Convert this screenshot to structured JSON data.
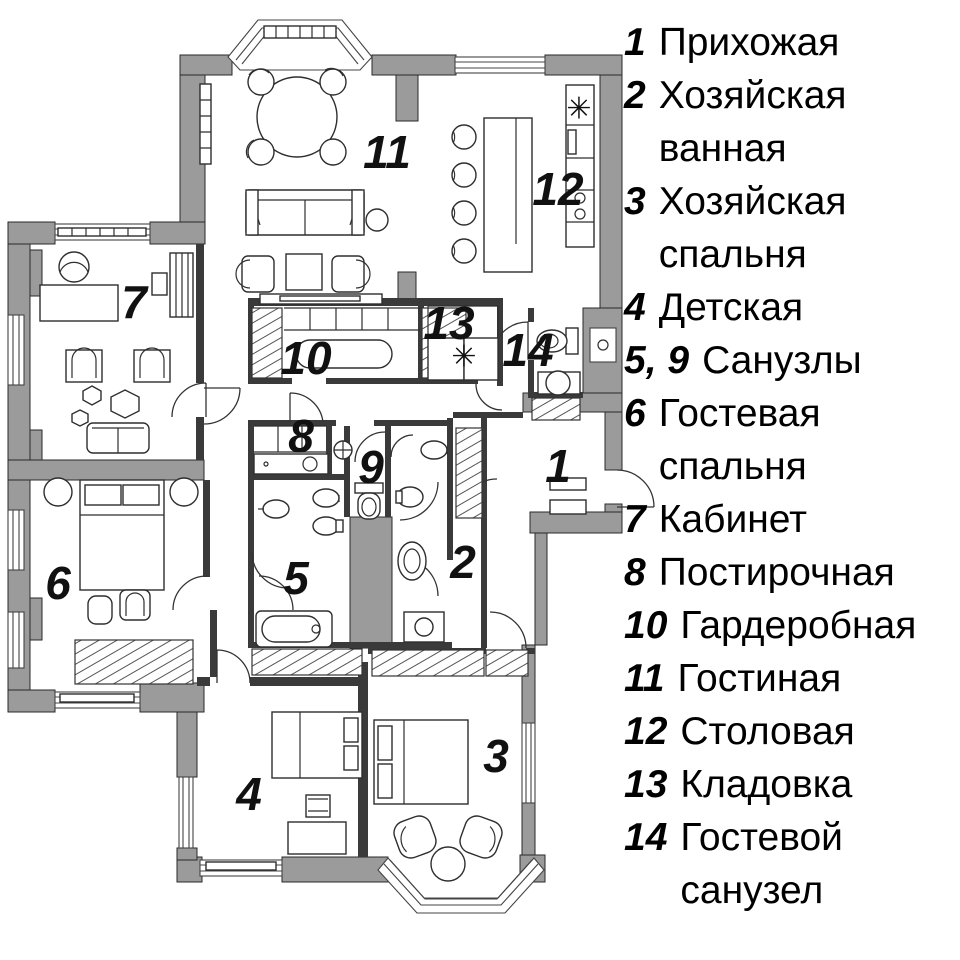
{
  "title": "Apartment floor plan with room legend",
  "colors": {
    "wall": "#9b9b9b",
    "line": "#2e2e2e",
    "background": "#ffffff",
    "text": "#000000"
  },
  "legend": {
    "items": [
      {
        "number": "1",
        "label": "Прихожая"
      },
      {
        "number": "2",
        "label": "Хозяйская ванная"
      },
      {
        "number": "3",
        "label": "Хозяйская спальня"
      },
      {
        "number": "4",
        "label": "Детская"
      },
      {
        "number": "5, 9",
        "label": "Санузлы"
      },
      {
        "number": "6",
        "label": "Гостевая спальня"
      },
      {
        "number": "7",
        "label": "Кабинет"
      },
      {
        "number": "8",
        "label": "Постирочная"
      },
      {
        "number": "10",
        "label": "Гардеробная"
      },
      {
        "number": "11",
        "label": "Гостиная"
      },
      {
        "number": "12",
        "label": "Столовая"
      },
      {
        "number": "13",
        "label": "Кладовка"
      },
      {
        "number": "14",
        "label": "Гостевой санузел"
      }
    ]
  },
  "plan": {
    "room_labels": [
      {
        "number": "1",
        "x": 558,
        "y": 470
      },
      {
        "number": "2",
        "x": 463,
        "y": 566
      },
      {
        "number": "3",
        "x": 496,
        "y": 760
      },
      {
        "number": "4",
        "x": 249,
        "y": 798
      },
      {
        "number": "5",
        "x": 296,
        "y": 582
      },
      {
        "number": "6",
        "x": 58,
        "y": 587
      },
      {
        "number": "7",
        "x": 134,
        "y": 306
      },
      {
        "number": "8",
        "x": 301,
        "y": 440
      },
      {
        "number": "9",
        "x": 371,
        "y": 471
      },
      {
        "number": "10",
        "x": 306,
        "y": 362
      },
      {
        "number": "11",
        "x": 387,
        "y": 156
      },
      {
        "number": "12",
        "x": 558,
        "y": 193
      },
      {
        "number": "13",
        "x": 449,
        "y": 327
      },
      {
        "number": "14",
        "x": 528,
        "y": 354
      }
    ],
    "symbols": [
      {
        "glyph": "✳",
        "x": 579,
        "y": 110,
        "name": "cooktop-symbol"
      },
      {
        "glyph": "✳",
        "x": 464,
        "y": 358,
        "name": "appliance-symbol"
      }
    ]
  }
}
